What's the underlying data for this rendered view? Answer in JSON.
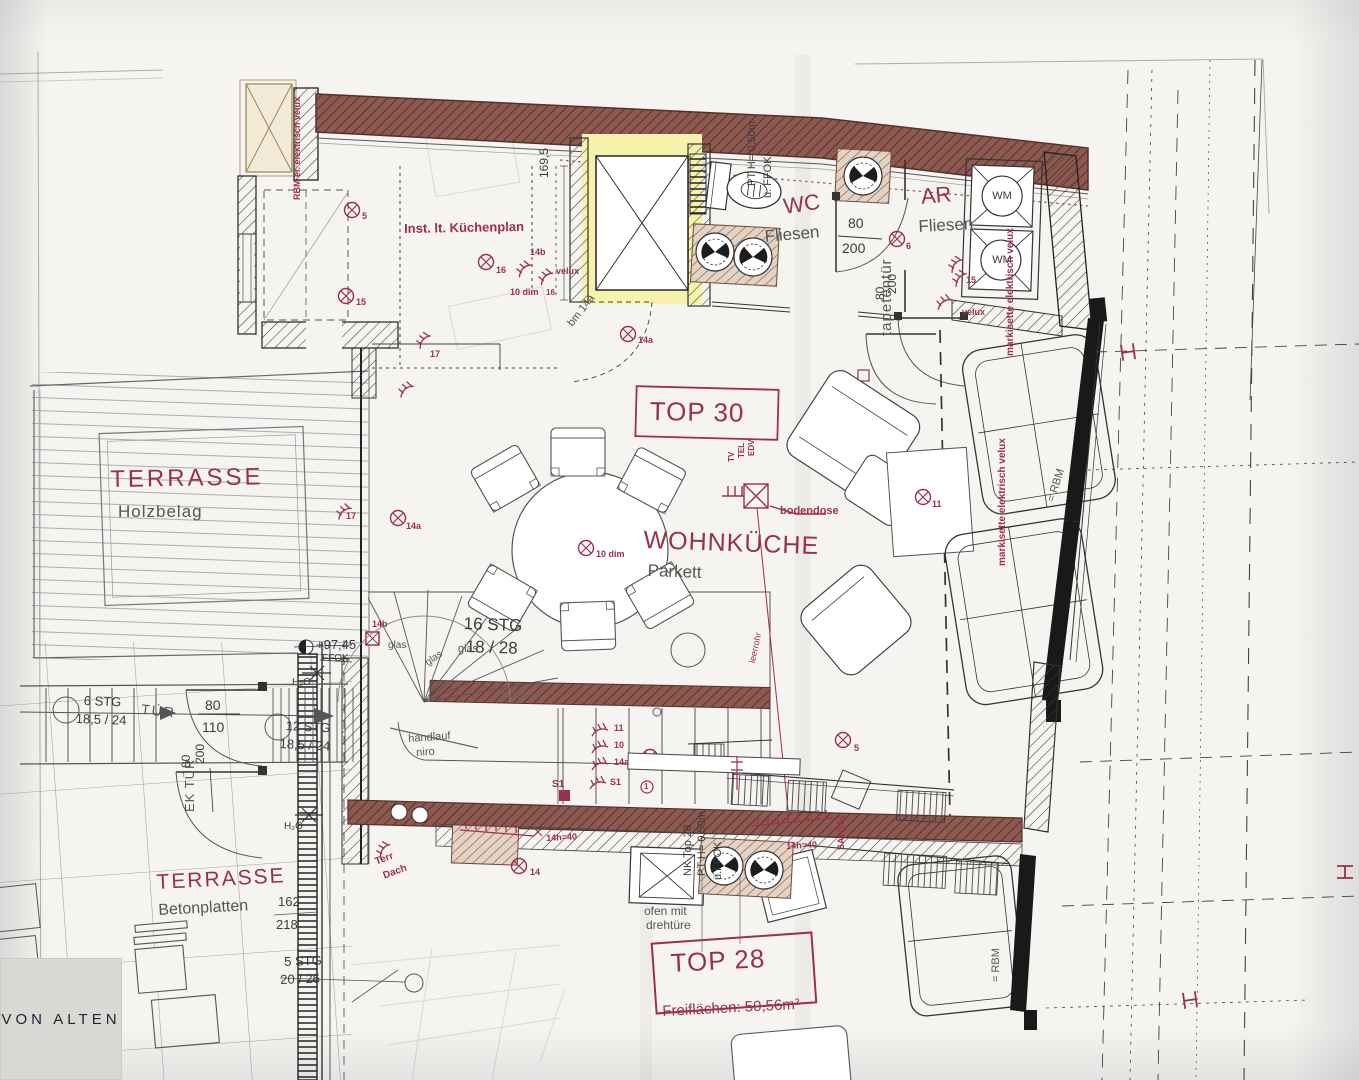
{
  "colors": {
    "annotation_red": "#9c2f4c",
    "room_red": "#993149",
    "wall_brick": "#8d5a51",
    "highlight_yellow": "#f6f1ab",
    "paper": "#f5f4f0"
  },
  "logo": {
    "text": "VON ALTEN"
  },
  "terrace_top": {
    "name": "TERRASSE",
    "floor": "Holzbelag"
  },
  "terrace_bottom": {
    "name": "TERRASSE",
    "floor": "Betonplatten",
    "dim_a": "162",
    "dim_b": "218",
    "stair": "5 STG",
    "stair_dim": "20 / 26",
    "terr": "Terr",
    "dach": "Dach",
    "sym14": "14"
  },
  "left_stairs": {
    "s6": "6 STG",
    "s6_dim": "18,5 / 24",
    "tuer": "TÜR",
    "door_w": "80",
    "door_h": "110",
    "s12": "12 STG",
    "s12_dim": "18,5 / 24",
    "ek_w": "80",
    "ek_h": "200",
    "ek": "EK TÜR",
    "h2o_a": "H₂O",
    "h2o_b": "H₂O",
    "level": "+97,45",
    "ffok": "FFOK"
  },
  "main_stairs": {
    "label": "16 STG",
    "dim": "18 / 28",
    "sym14b": "14b",
    "glas_a": "glas",
    "glas_b": "glas",
    "glas_c": "glas",
    "handlauf_a": "handlauf",
    "handlauf_b": "niro",
    "h100": "h=100 cm",
    "s1": "S1",
    "sym11": "11",
    "sym10": "10",
    "sym14a": "14a",
    "sym_s1": "S1",
    "sym1": "1"
  },
  "kitchen": {
    "note": "Inst. lt. Küchenplan",
    "dim": "169,5",
    "sym16": "16",
    "sym14b": "14b",
    "sym10dim": "10 dim",
    "sym16b": "16",
    "velux": "velux",
    "bm14a": "bm 14a",
    "sym14a": "14a",
    "sym17": "17"
  },
  "closet": {
    "note": "RBM el. elektrisch velux",
    "sym5": "5",
    "sym15": "15"
  },
  "wc": {
    "label": "WC",
    "floor": "Fliesen",
    "pt": "PT H= 0,50m",
    "ffok": "ü. FFOK",
    "door_w": "80",
    "door_h": "200",
    "sym6": "6"
  },
  "ar": {
    "label": "AR",
    "floor": "Fliesen",
    "wm_a": "WM",
    "wm_b": "WM",
    "door_w": "80",
    "door_h": "200",
    "velux": "velux",
    "sym15": "15",
    "tapeten": "tapetentür"
  },
  "living": {
    "top": "TOP 30",
    "name": "WOHNKÜCHE",
    "floor": "Parkett",
    "bodendose": "bodendose",
    "tv": "TV",
    "tel": "TEL",
    "edv": "EDV",
    "table_sym": "10 dim",
    "sym11": "11",
    "sym5": "5",
    "sym14a": "14a",
    "sym17": "17",
    "leerrohr": "leerrohr"
  },
  "windows_right": {
    "note_a": "markisette elektrisch velux",
    "note_b": "markisette elektrisch velux",
    "rbm_a": "= RBM",
    "rbm_b": "= RBM"
  },
  "bottom": {
    "nk": "NK Top 28",
    "pt": "PT H= 0,50m",
    "ffok": "ü.FFOK",
    "ofen_a": "ofen mit",
    "ofen_b": "drehtüre",
    "top28": "TOP 28",
    "frei": "Freiflächen: 50,56m²",
    "sat": "SAT/TEL",
    "sym14h_a": "14h=40",
    "sym14h_b": "14h=40"
  }
}
